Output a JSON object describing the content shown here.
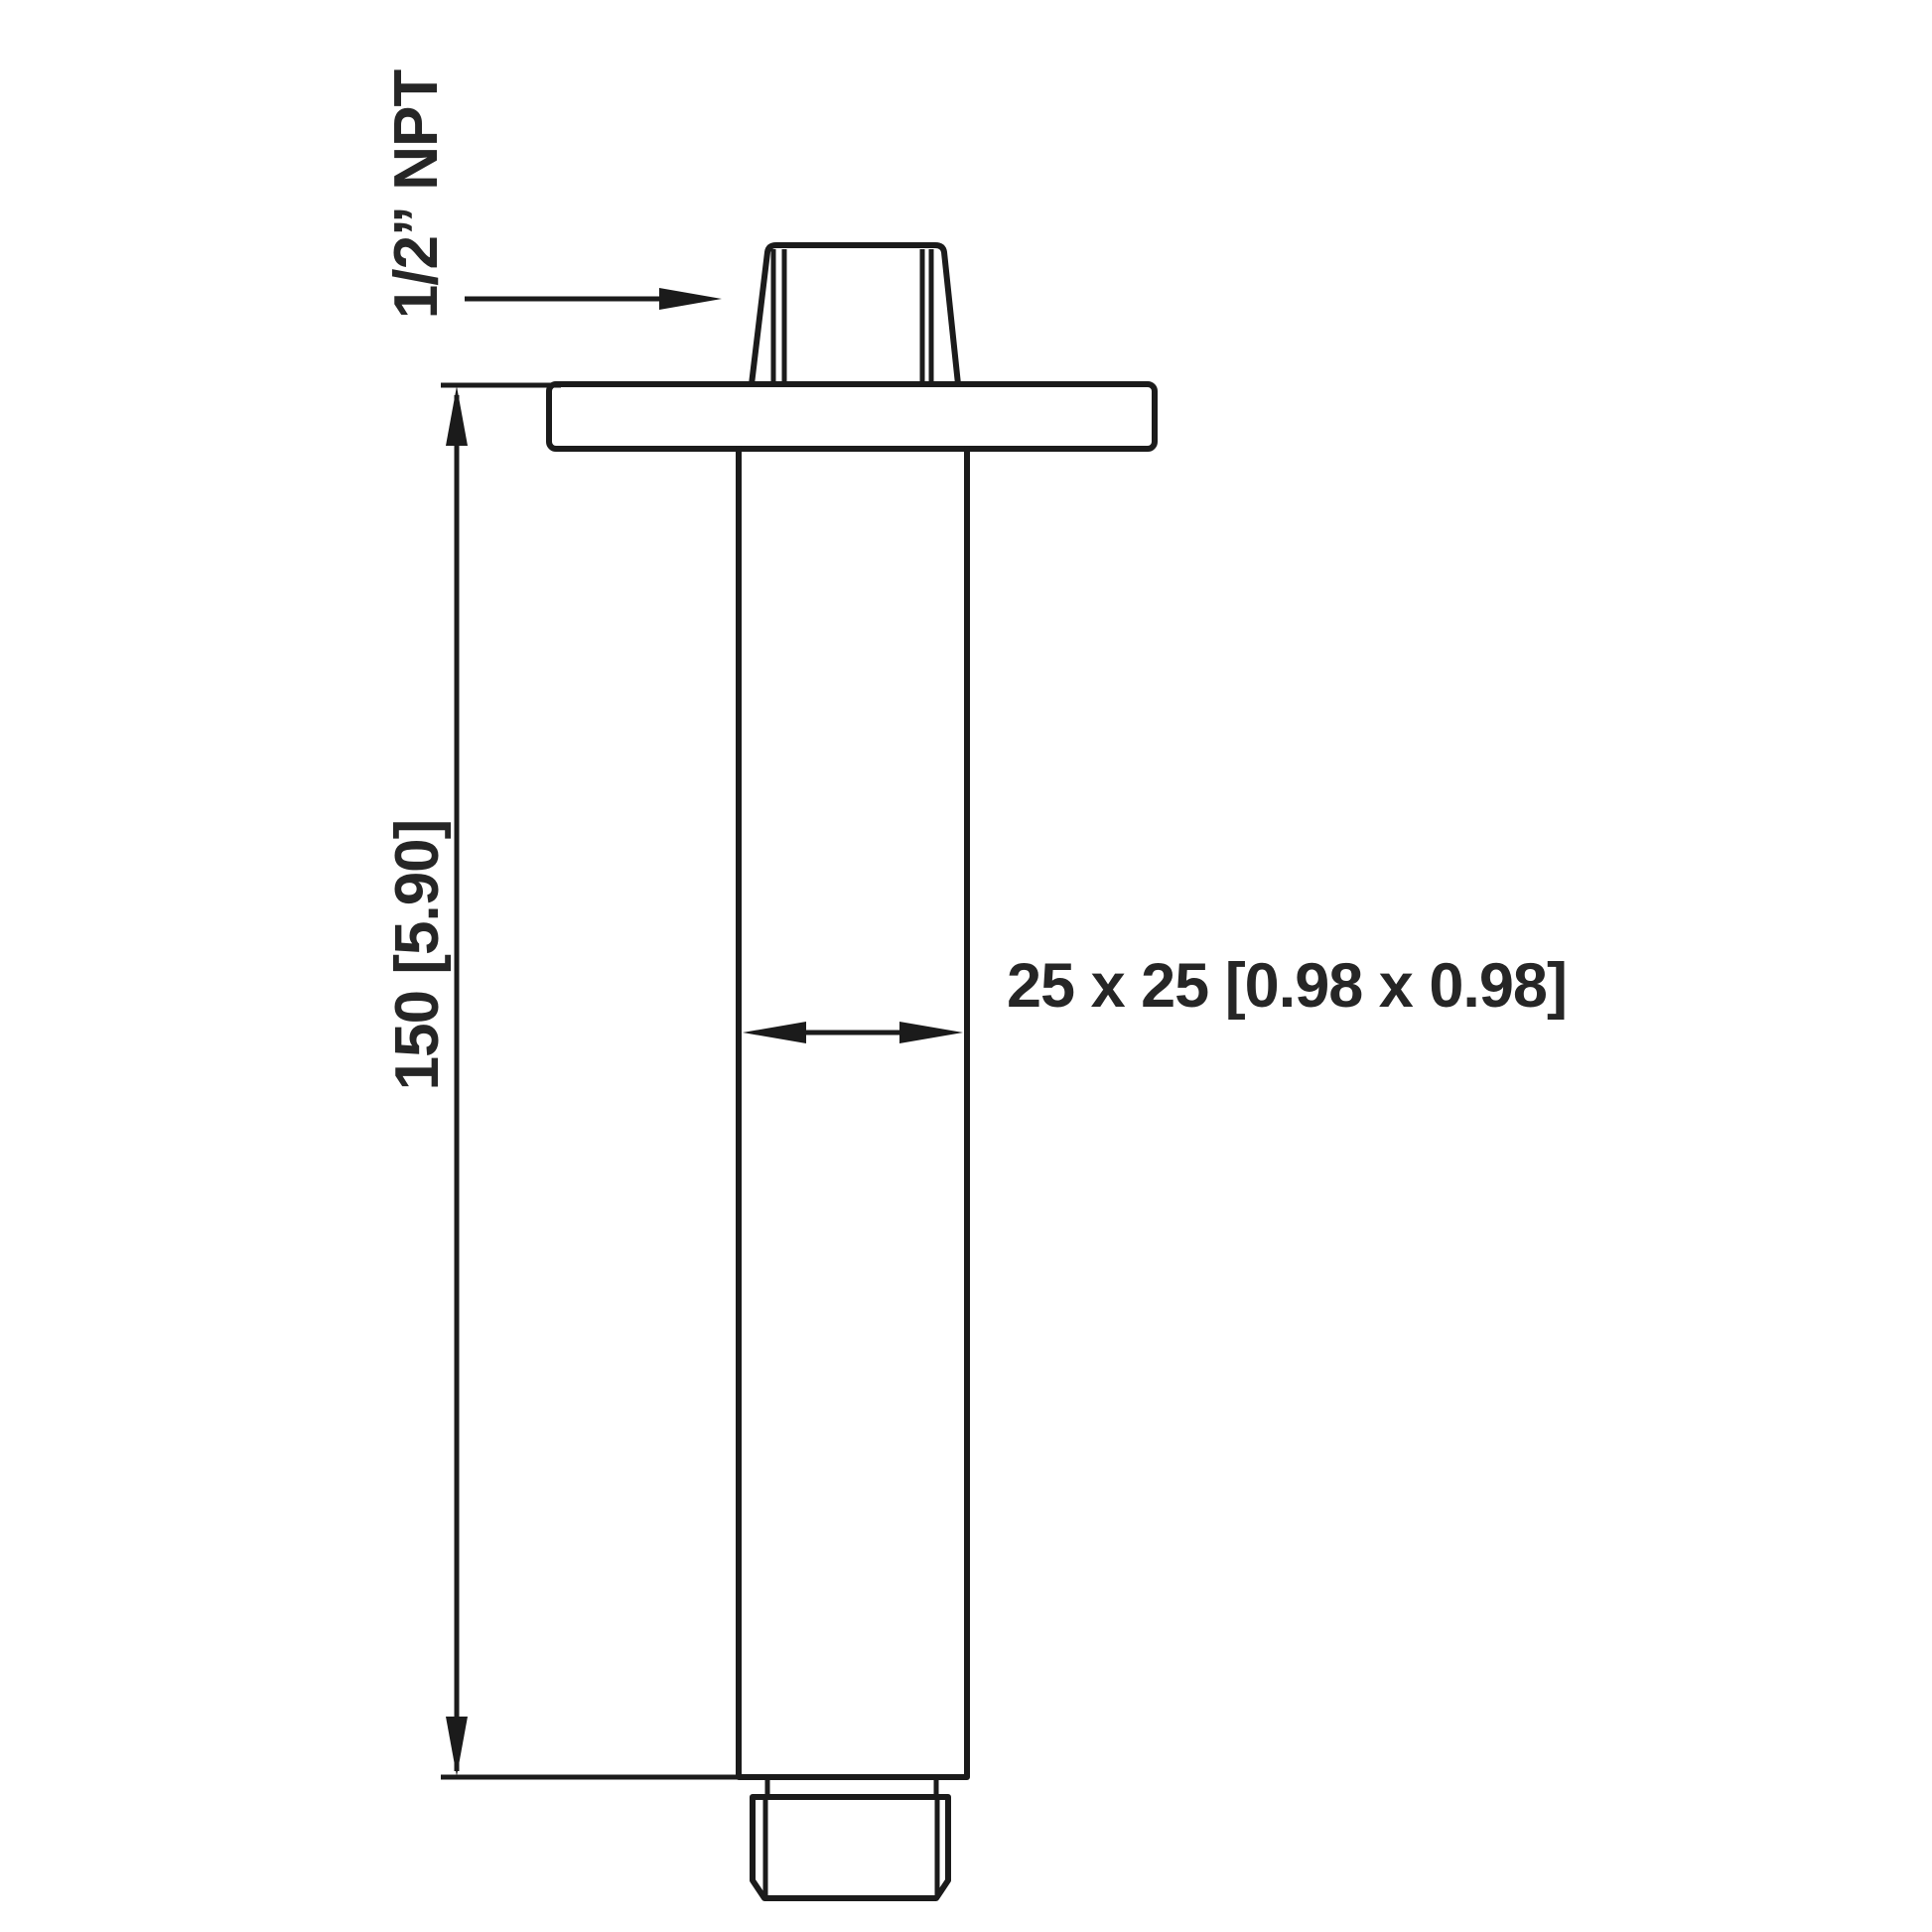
{
  "drawing": {
    "background_color": "#ffffff",
    "line_color": "#1b1b1b",
    "text_color": "#262626",
    "labels": {
      "thread": "1/2” NPT",
      "height": "150 [5.90]",
      "width": "25 x 25 [0.98 x 0.98]"
    }
  }
}
